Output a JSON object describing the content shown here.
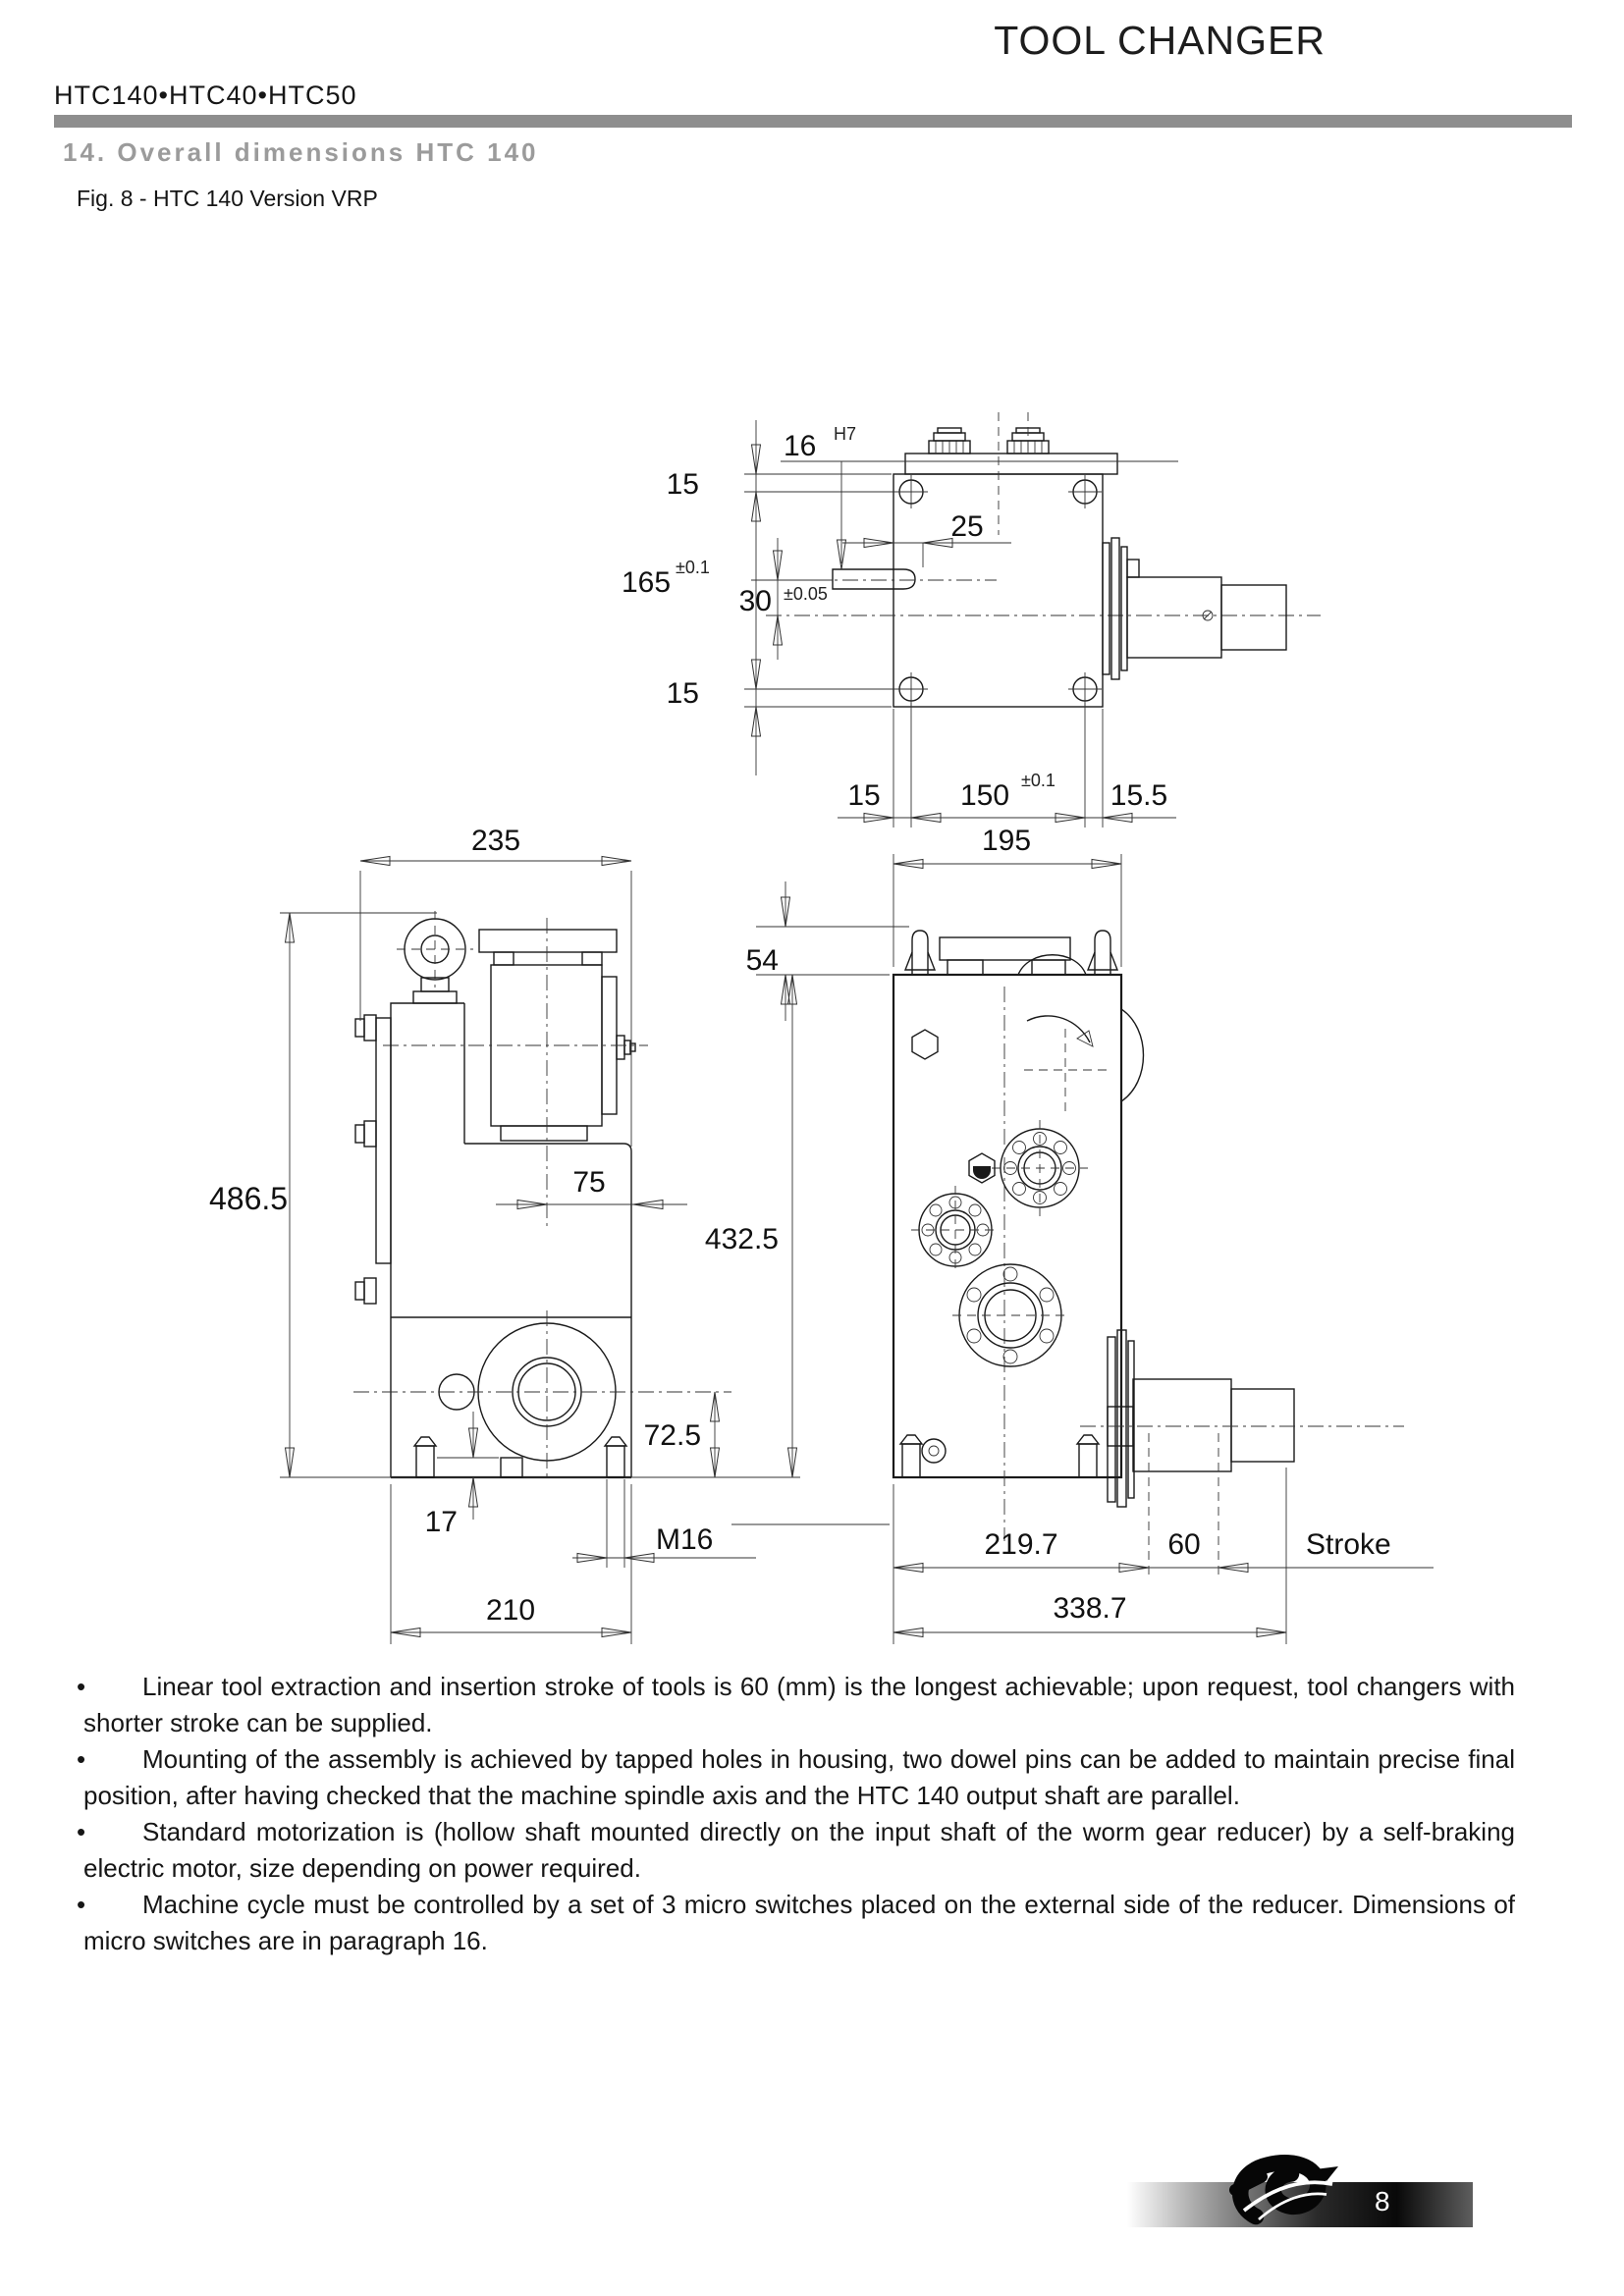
{
  "header": {
    "doc_title": "TOOL CHANGER",
    "models": "HTC140•HTC40•HTC50",
    "section_title": "14. Overall dimensions HTC 140",
    "figure_caption": "Fig. 8 - HTC 140 Version VRP"
  },
  "drawing": {
    "top_view": {
      "dim_15_top": "15",
      "dim_16": "16",
      "dim_16_tol": "H7",
      "dim_165": "165",
      "dim_165_tol": "±0.1",
      "dim_30": "30",
      "dim_30_tol": "±0.05",
      "dim_25": "25",
      "dim_15_bottom": "15",
      "dim_15_base": "15",
      "dim_150": "150",
      "dim_150_tol": "±0.1",
      "dim_15_5": "15.5"
    },
    "side_view": {
      "dim_235": "235",
      "dim_486_5": "486.5",
      "dim_75": "75",
      "dim_72_5": "72.5",
      "dim_17": "17",
      "dim_m16": "M16",
      "dim_210": "210"
    },
    "front_view": {
      "dim_195": "195",
      "dim_54": "54",
      "dim_432_5": "432.5",
      "dim_219_7": "219.7",
      "dim_60": "60",
      "stroke_label": "Stroke",
      "dim_338_7": "338.7"
    }
  },
  "notes": {
    "bullet": "•",
    "items": [
      "Linear tool extraction and insertion stroke of tools is 60 (mm) is the longest achievable; upon request, tool changers with shorter stroke can be supplied.",
      "Mounting of the assembly is achieved by tapped holes in housing, two dowel pins can be added to maintain precise final position, after having checked that the machine spindle axis and the HTC 140 output shaft are parallel.",
      "Standard motorization is (hollow shaft mounted directly on the input shaft of the worm gear reducer) by a self-braking electric motor, size depending on power required.",
      "Machine cycle must be controlled by a set of 3 micro switches placed on the external side of the reducer. Dimensions of micro switches are in paragraph 16."
    ]
  },
  "footer": {
    "page_number": "8"
  },
  "colors": {
    "accent_bar": "#8e8e8e",
    "section_title_gray": "#9b9b9b",
    "line": "#1a1a1a"
  }
}
